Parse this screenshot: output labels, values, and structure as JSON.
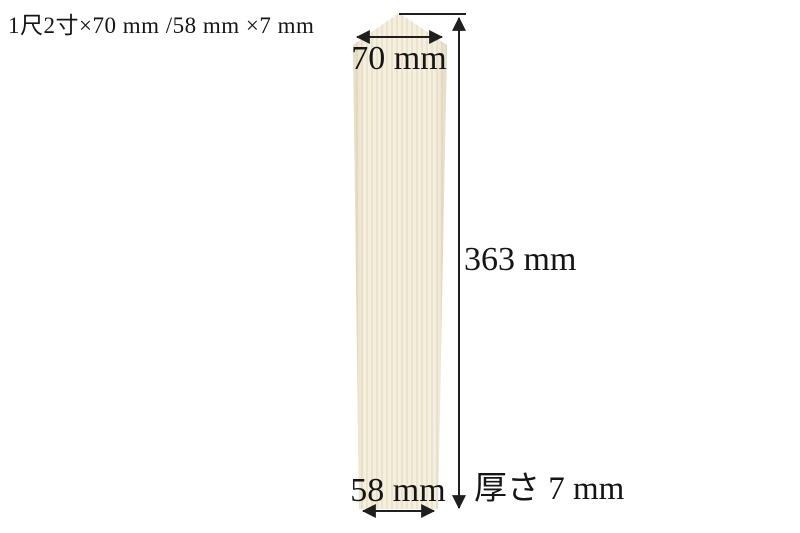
{
  "page": {
    "background_color": "#ffffff",
    "title": "1尺2寸×70 mm /58 mm ×7 mm"
  },
  "diagram": {
    "board": {
      "description": "tapered wooden sotoba board with peaked top",
      "fill_color": "#f4eedd",
      "grain_color": "#ebe3cc",
      "edge_shade_color": "#c3b28a"
    },
    "line_color": "#1f1f1f",
    "dimensions": {
      "top_width": "70 mm",
      "height": "363 mm",
      "bottom_width": "58 mm",
      "thickness": "厚さ 7 mm"
    }
  }
}
